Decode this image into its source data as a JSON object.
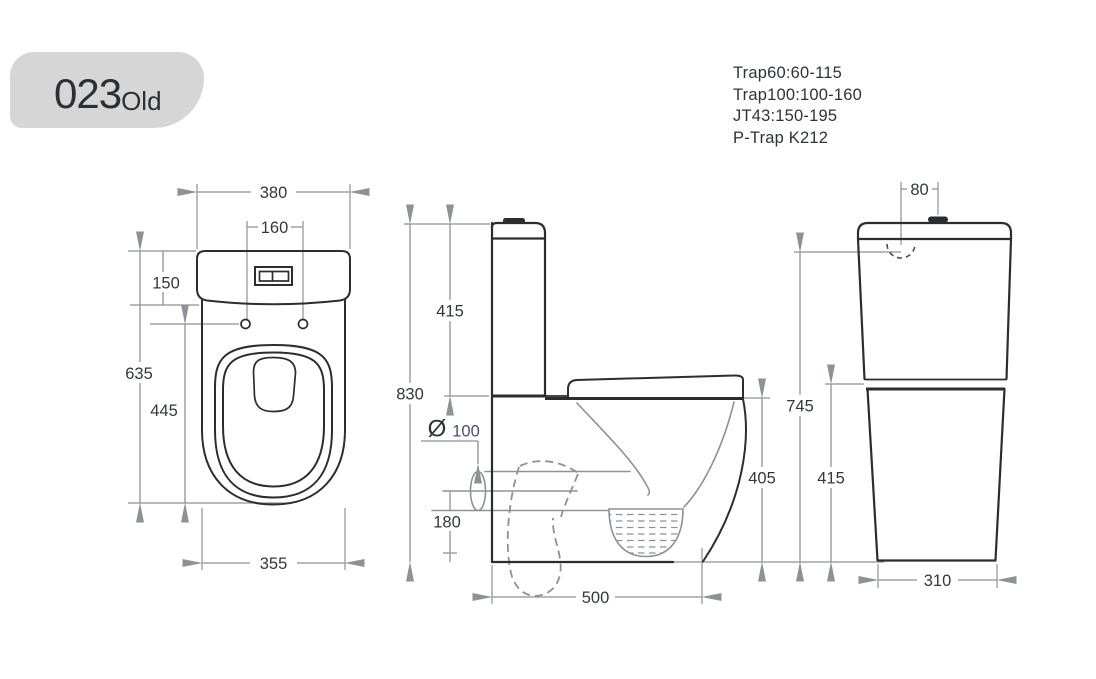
{
  "badge": {
    "model": "023",
    "suffix": "Old"
  },
  "trap_notes": {
    "line1": "Trap60:60-115",
    "line2": "Trap100:100-160",
    "line3": "JT43:150-195",
    "line4": "P-Trap K212"
  },
  "front_view": {
    "dims": {
      "top_width": "380",
      "bolt_spacing": "160",
      "cistern_height": "150",
      "overall_height": "635",
      "bowl_depth": "445",
      "base_width": "355"
    }
  },
  "side_view": {
    "dims": {
      "overall_height": "830",
      "cistern_height": "415",
      "outlet_diameter_symbol": "Ø",
      "outlet_diameter": "100",
      "outlet_center_height": "180",
      "seat_height": "405",
      "overall_depth": "500"
    }
  },
  "back_view": {
    "dims": {
      "inlet_offset": "80",
      "overall_height": "745",
      "body_height": "415",
      "base_width": "310"
    }
  },
  "colors": {
    "line": "#2b2d30",
    "dimension_gray": "#8e9297",
    "text": "#34383c",
    "badge_bg": "#d6d6d6",
    "diameter_value_blue": "#44507c"
  }
}
